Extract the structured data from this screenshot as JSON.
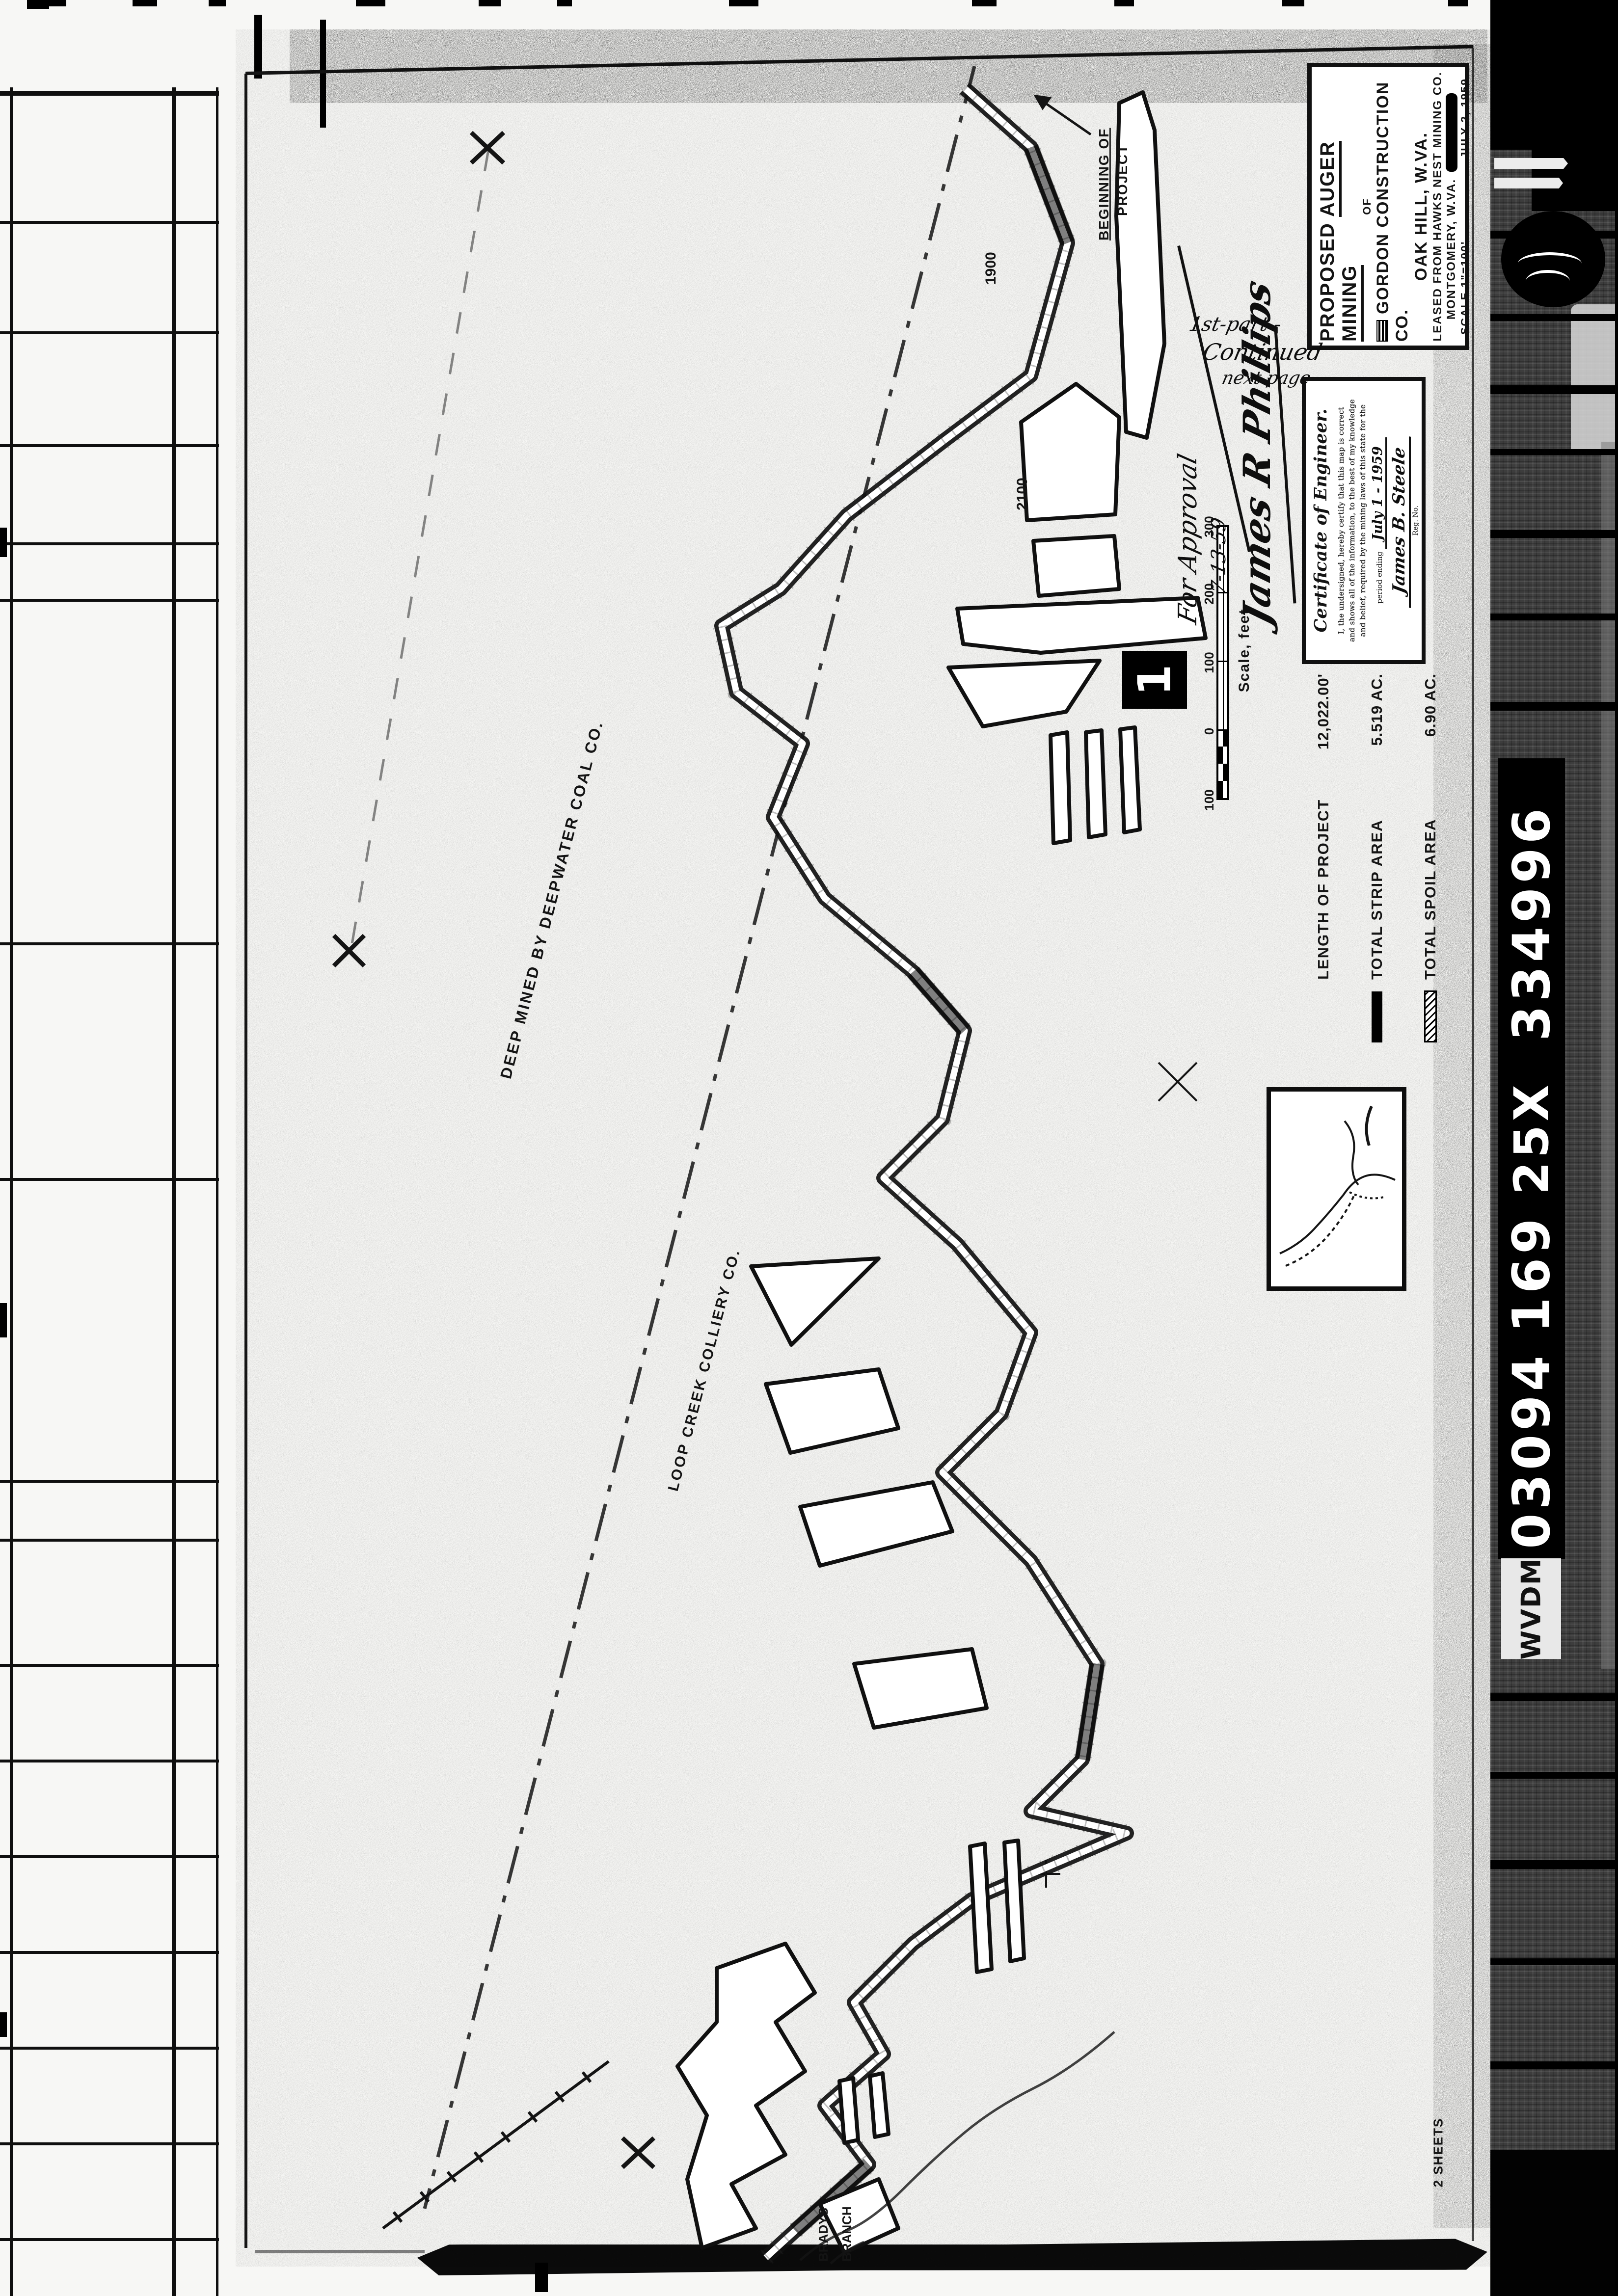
{
  "document": {
    "kind": "Scanned microfilm sheet - proposed auger/strip mining map",
    "colors": {
      "ink": "#141414",
      "paper": "#f7f7f5",
      "film_black": "#000000"
    }
  },
  "title_block": {
    "line1_pre": "PROPOSED",
    "line1_underlined": "AUGER MINING",
    "line2": "OF",
    "line3": "GORDON CONSTRUCTION CO.",
    "line4": "OAK HILL, W.VA.",
    "line5": "LEASED FROM HAWKS NEST MINING CO.",
    "line6": "MONTGOMERY, W.VA.",
    "scale": "SCALE 1\"=100'",
    "date": "JULY 2, 1959"
  },
  "certificate": {
    "heading": "Certificate of Engineer.",
    "lines": [
      "I, the undersigned, hereby certify that this map is correct",
      "and shows all of the information, to the best of my knowledge",
      "and belief, required by the mining laws of this state for the"
    ],
    "period_label": "period ending",
    "period_value": "July 1 - 1959",
    "signature": "James B. Steele",
    "signature_suffix": "Reg. No."
  },
  "legend": {
    "rows": [
      {
        "label": "LENGTH OF PROJECT",
        "value": "12,022.00'"
      },
      {
        "label": "TOTAL STRIP AREA",
        "value": "5.519 AC."
      },
      {
        "label": "TOTAL SPOIL AREA",
        "value": "6.90 AC."
      }
    ]
  },
  "scale_bar": {
    "label": "Scale, feet",
    "ticks": [
      "100",
      "0",
      "100",
      "200",
      "300"
    ]
  },
  "stamp": {
    "number": "1"
  },
  "annotations": {
    "approval": "For Approval",
    "approval_date": "7-13-59",
    "approval_signature": "James R Phillips",
    "note_line1": "1st-part -",
    "note_line2": "Continued",
    "note_line3": "next page",
    "beginning_line1": "BEGINNING OF",
    "beginning_line2": "PROJECT",
    "deep_mined": "DEEP MINED BY DEEPWATER COAL CO.",
    "boundary_owner": "LOOP CREEK COLLIERY CO.",
    "stream_word1": "BRADYS",
    "stream_word2": "BRANCH",
    "station_1": "1900",
    "station_2": "2100",
    "sheets": "2 SHEETS"
  },
  "film_strip": {
    "agency": "WVDM",
    "code_parts": [
      "03094",
      "169",
      "25X",
      "334996"
    ]
  }
}
